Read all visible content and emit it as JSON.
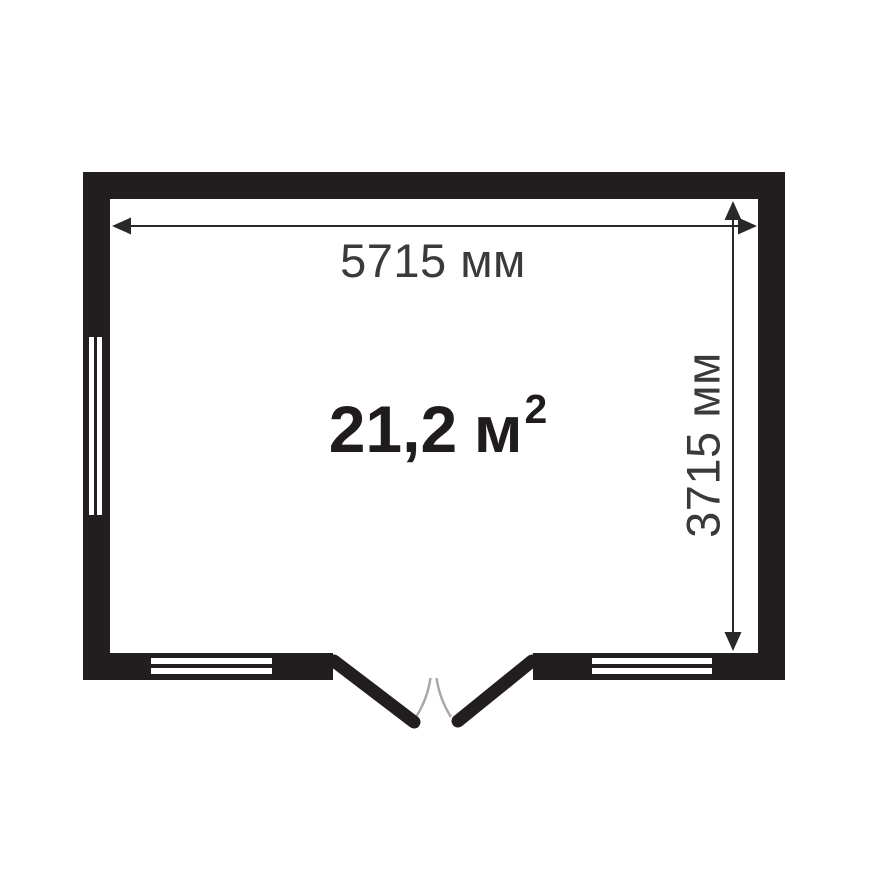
{
  "floorplan": {
    "type": "room-plan",
    "area": {
      "value": "21,2",
      "unit": "м",
      "sup": "2"
    },
    "dimensions": {
      "width": "5715 мм",
      "height": "3715 мм"
    },
    "features": {
      "windows": [
        "left-wall-window",
        "bottom-left-window",
        "bottom-right-window"
      ],
      "door": "double-door-bottom-center-opening-outward"
    },
    "colors": {
      "wall": "#221e1f",
      "dimension": "#2a2928",
      "label": "#3b3a39",
      "area_text": "#201c1d",
      "door_arc": "#a8a8a8",
      "background": "#ffffff"
    }
  }
}
